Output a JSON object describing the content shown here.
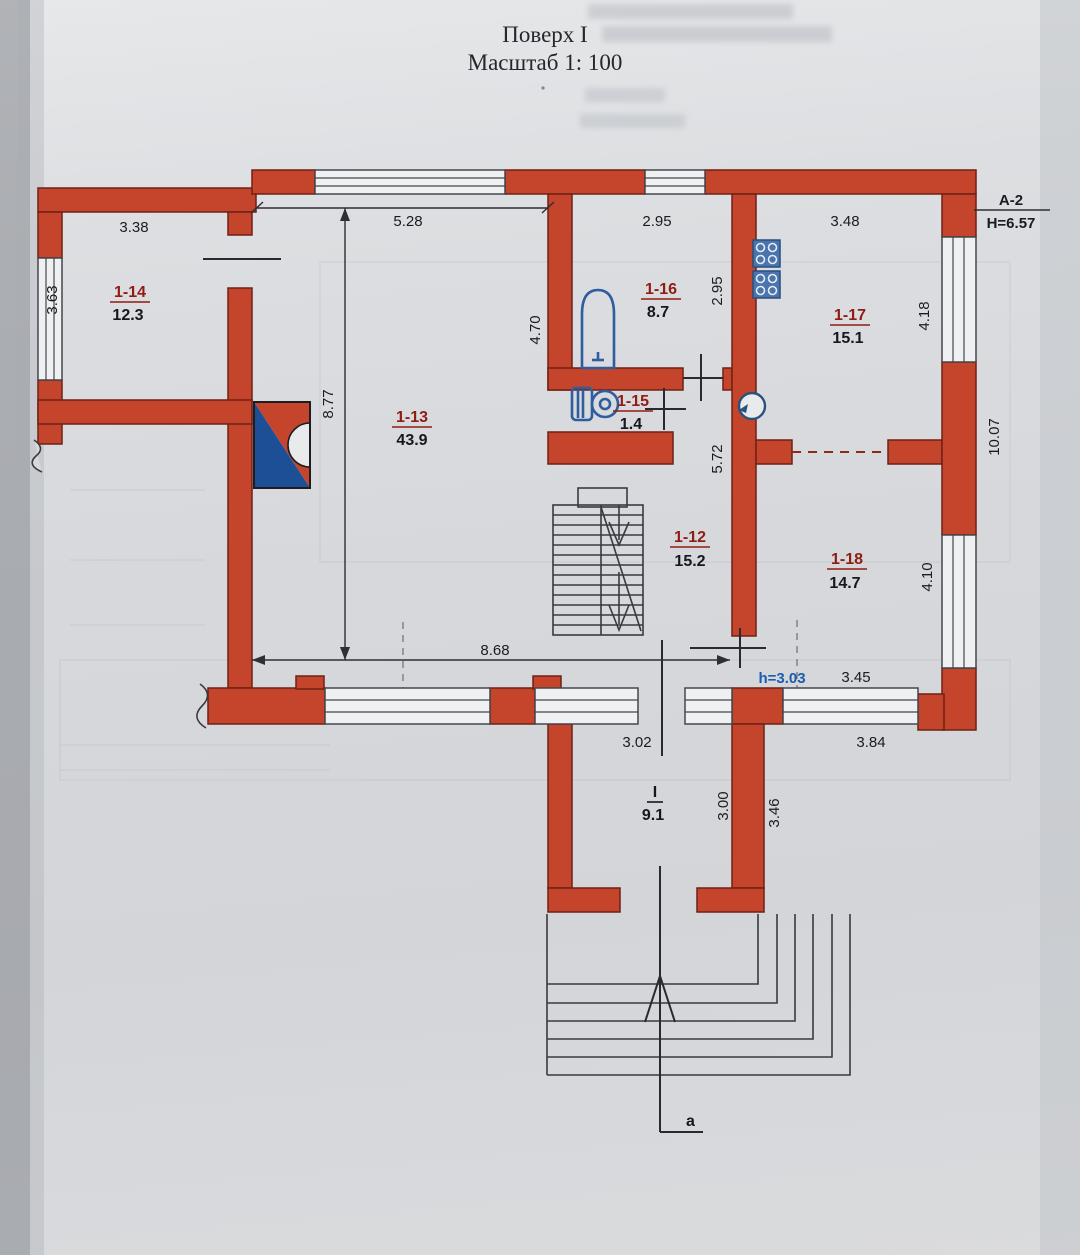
{
  "page": {
    "title_line1": "Поверх I",
    "title_line2": "Масштаб 1: 100"
  },
  "plan": {
    "axis_mark": {
      "label": "A-2",
      "height": "H=6.57"
    },
    "ceiling_height": "h=3.03",
    "section_label": "a",
    "rooms": {
      "r12": {
        "number": "1-12",
        "area": "15.2"
      },
      "r13": {
        "number": "1-13",
        "area": "43.9"
      },
      "r14": {
        "number": "1-14",
        "area": "12.3"
      },
      "r15": {
        "number": "1-15",
        "area": "1.4"
      },
      "r16": {
        "number": "1-16",
        "area": "8.7"
      },
      "r17": {
        "number": "1-17",
        "area": "15.1"
      },
      "r18": {
        "number": "1-18",
        "area": "14.7"
      },
      "rI": {
        "number": "I",
        "area": "9.1"
      }
    },
    "dimensions": {
      "room14_width": "3.38",
      "room14_depth": "3.63",
      "room13_width": "5.28",
      "room13_depth": "8.77",
      "room13_inner": "4.70",
      "room16_width": "2.95",
      "room16_depth": "2.95",
      "room17_width": "3.48",
      "room17_depth": "4.18",
      "right_side_total": "10.07",
      "hall_depth": "5.72",
      "room18_depth": "4.10",
      "room18_width": "3.45",
      "room18_outer": "3.84",
      "bottom_span": "8.68",
      "vestibule_width": "3.02",
      "vestibule_depth": "3.00",
      "vestibule_outer": "3.46"
    },
    "colors": {
      "wall": "#c4452b",
      "fixture": "#2f5d9d",
      "accent_blue": "#1c4f95",
      "label_red": "#8f1d12",
      "line": "#3a3a3e"
    }
  }
}
